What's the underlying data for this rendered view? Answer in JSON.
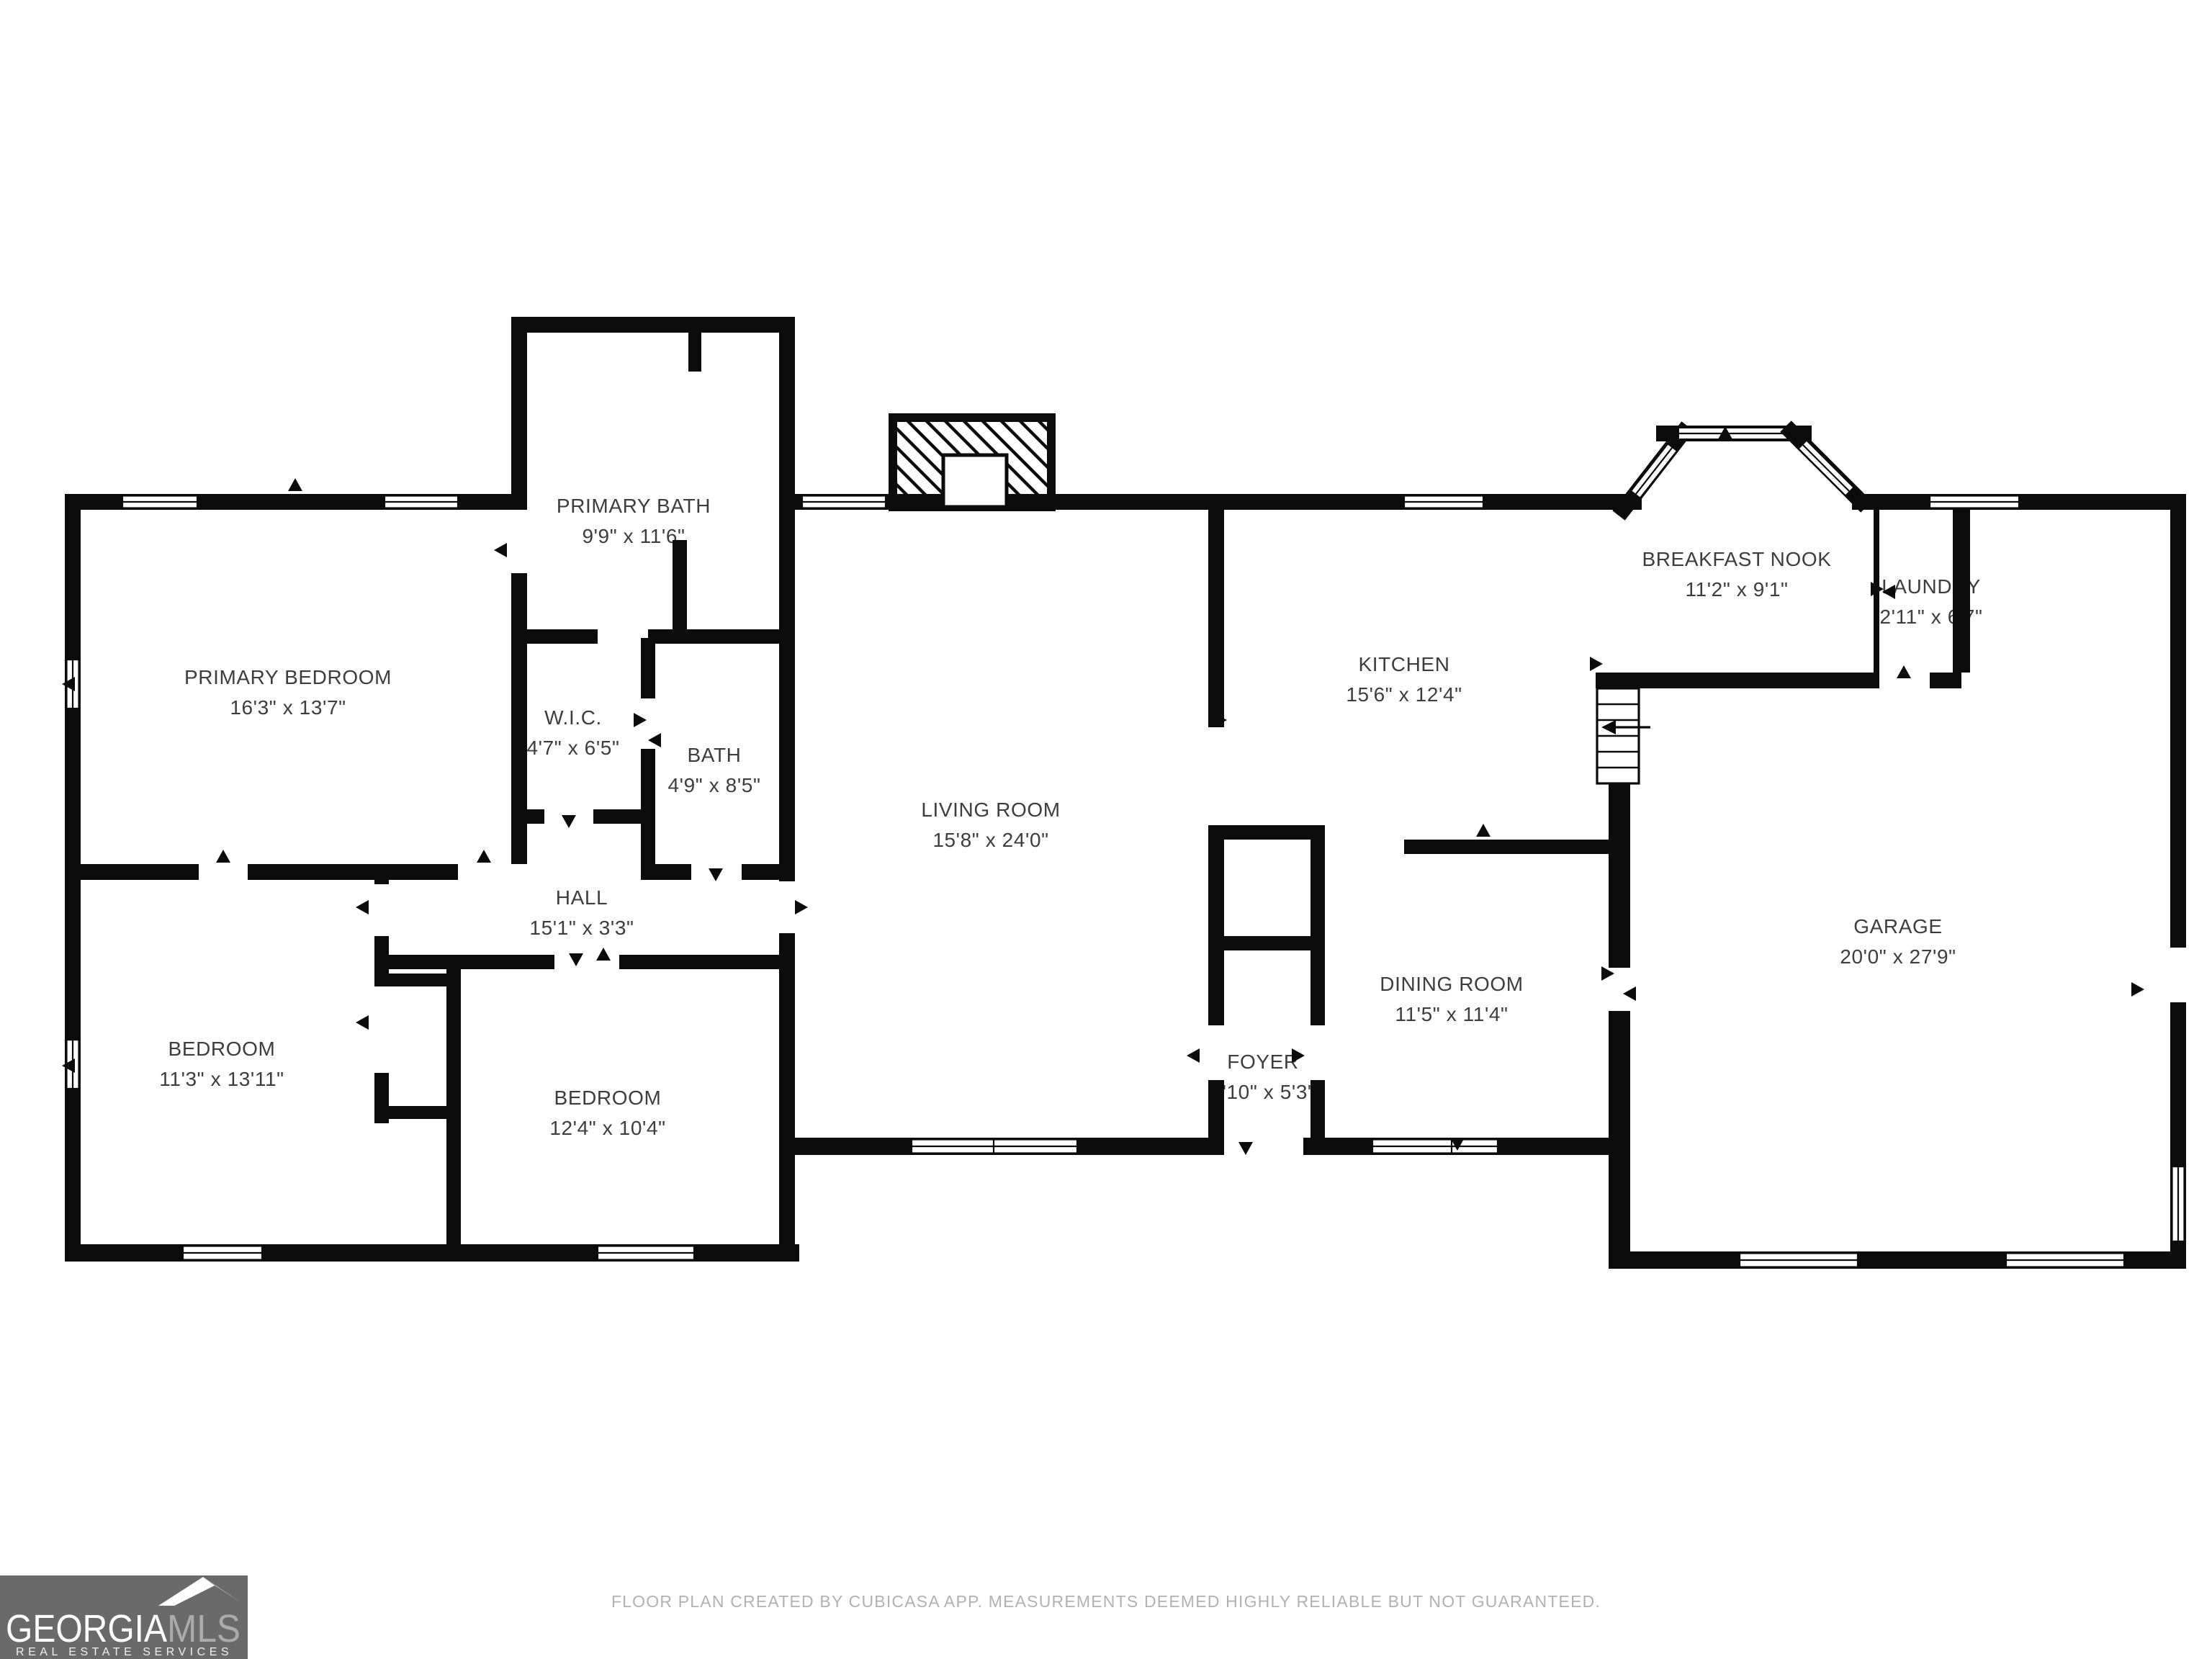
{
  "rooms": {
    "primary_bath": {
      "name": "PRIMARY BATH",
      "dims": "9'9\" x 11'6\""
    },
    "primary_bedroom": {
      "name": "PRIMARY BEDROOM",
      "dims": "16'3\" x 13'7\""
    },
    "wic": {
      "name": "W.I.C.",
      "dims": "4'7\" x 6'5\""
    },
    "bath": {
      "name": "BATH",
      "dims": "4'9\" x 8'5\""
    },
    "hall": {
      "name": "HALL",
      "dims": "15'1\" x 3'3\""
    },
    "bedroom_left": {
      "name": "BEDROOM",
      "dims": "11'3\" x 13'11\""
    },
    "bedroom_mid": {
      "name": "BEDROOM",
      "dims": "12'4\" x 10'4\""
    },
    "living_room": {
      "name": "LIVING ROOM",
      "dims": "15'8\" x 24'0\""
    },
    "kitchen": {
      "name": "KITCHEN",
      "dims": "15'6\" x 12'4\""
    },
    "breakfast_nook": {
      "name": "BREAKFAST NOOK",
      "dims": "11'2\" x 9'1\""
    },
    "laundry": {
      "name": "LAUNDRY",
      "dims": "2'11\" x 6'7\""
    },
    "dining_room": {
      "name": "DINING ROOM",
      "dims": "11'5\" x 11'4\""
    },
    "foyer": {
      "name": "FOYER",
      "dims": "3'10\" x 5'3\""
    },
    "garage": {
      "name": "GARAGE",
      "dims": "20'0\" x 27'9\""
    }
  },
  "footer": {
    "disclaimer": "FLOOR PLAN CREATED BY CUBICASA APP. MEASUREMENTS DEEMED HIGHLY RELIABLE BUT NOT GUARANTEED."
  },
  "logo": {
    "brand_primary": "GEORGIA",
    "brand_secondary": "MLS",
    "tagline": "REAL ESTATE SERVICES"
  },
  "colors": {
    "wall": "#0b0b0b",
    "label_text": "#3d3d3d",
    "disclaimer_text": "#b2b2b2",
    "logo_background": "#6a6a6a",
    "logo_mls_text": "#ababab",
    "logo_roof_light": "#ffffff",
    "logo_roof_shade": "#b5b5b5"
  }
}
